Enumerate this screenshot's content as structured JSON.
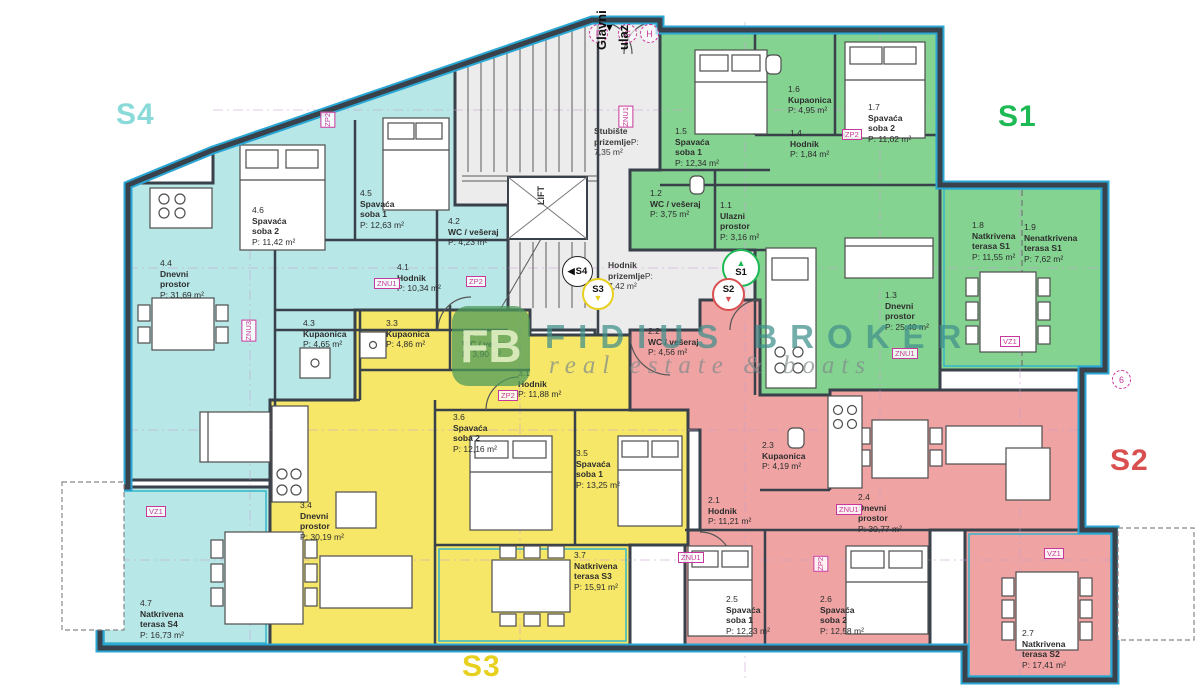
{
  "colors": {
    "s1": "#84d391",
    "s2": "#efa3a3",
    "s3": "#f6e768",
    "s4": "#b7e7e7",
    "common": "#ececec",
    "wall": "#39414a",
    "blue": "#2aa6d4",
    "tag": "#c8379b",
    "grid": "#c9a0cf",
    "s1-accent": "#1db954",
    "s2-accent": "#d94f4f",
    "s3-accent": "#e8d020",
    "s4-accent": "#8adada"
  },
  "units": {
    "s1": "S1",
    "s2": "S2",
    "s3": "S3",
    "s4": "S4"
  },
  "entrance": {
    "word1": "Glavni",
    "word2": "ulaz",
    "arrow": "▼"
  },
  "grid_bubbles": {
    "f": "F",
    "g": "G",
    "h": "H",
    "side": "6"
  },
  "badge_arrows": {
    "up": "▲",
    "down": "▼",
    "left": "◀"
  },
  "common_rooms": {
    "stairs_name": "Stubište prizemlje",
    "stairs_area": "P: 7,35 m²",
    "hall_name": "Hodnik prizemlje",
    "hall_area": "P: 7,42 m²",
    "lift": "LIFT"
  },
  "watermark": {
    "logo": "FB",
    "line1": "FIDIUS BROKER",
    "line2": "real estate & boats"
  },
  "tags": {
    "zp2": "ZP2",
    "znu1": "ZNU1",
    "znu3": "ZNU3",
    "vz1": "VZ1"
  },
  "apartments": [
    {
      "id": "S4",
      "rooms": [
        {
          "number": "4.1",
          "name": "Hodnik",
          "area": "P: 10,34 m²"
        },
        {
          "number": "4.2",
          "name": "WC / vešeraj",
          "area": "P: 4,23 m²"
        },
        {
          "number": "4.3",
          "name": "Kupaonica",
          "area": "P: 4,65 m²"
        },
        {
          "number": "4.4",
          "name": "Dnevni prostor",
          "area": "P: 31,69 m²"
        },
        {
          "number": "4.5",
          "name": "Spavaća soba 1",
          "area": "P: 12,63 m²"
        },
        {
          "number": "4.6",
          "name": "Spavaća soba 2",
          "area": "P: 11,42 m²"
        },
        {
          "number": "4.7",
          "name": "Natkrivena terasa S4",
          "area": "P: 16,73 m²"
        }
      ]
    },
    {
      "id": "S1",
      "rooms": [
        {
          "number": "1.1",
          "name": "Ulazni prostor",
          "area": "P: 3,16 m²"
        },
        {
          "number": "1.2",
          "name": "WC / vešeraj",
          "area": "P: 3,75 m²"
        },
        {
          "number": "1.3",
          "name": "Dnevni prostor",
          "area": "P: 25,40 m²"
        },
        {
          "number": "1.4",
          "name": "Hodnik",
          "area": "P: 1,84 m²"
        },
        {
          "number": "1.5",
          "name": "Spavaća soba 1",
          "area": "P: 12,34 m²"
        },
        {
          "number": "1.6",
          "name": "Kupaonica",
          "area": "P: 4,95 m²"
        },
        {
          "number": "1.7",
          "name": "Spavaća soba 2",
          "area": "P: 11,02 m²"
        },
        {
          "number": "1.8",
          "name": "Natkrivena terasa S1",
          "area": "P: 11,55 m²"
        },
        {
          "number": "1.9",
          "name": "Nenatkrivena terasa S1",
          "area": "P: 7,62 m²"
        }
      ]
    },
    {
      "id": "S2",
      "rooms": [
        {
          "number": "2.1",
          "name": "Hodnik",
          "area": "P: 11,21 m²"
        },
        {
          "number": "2.2",
          "name": "WC / vešeraj",
          "area": "P: 4,56 m²"
        },
        {
          "number": "2.3",
          "name": "Kupaonica",
          "area": "P: 4,19 m²"
        },
        {
          "number": "2.4",
          "name": "Dnevni prostor",
          "area": "P: 30,77 m²"
        },
        {
          "number": "2.5",
          "name": "Spavaća soba 1",
          "area": "P: 12,23 m²"
        },
        {
          "number": "2.6",
          "name": "Spavaća soba 2",
          "area": "P: 12,58 m²"
        },
        {
          "number": "2.7",
          "name": "Natkrivena terasa S2",
          "area": "P: 17,41 m²"
        }
      ]
    },
    {
      "id": "S3",
      "rooms": [
        {
          "number": "3.1",
          "name": "Hodnik",
          "area": "P: 11,88 m²"
        },
        {
          "number": "3.2",
          "name": "WC / vešeraj",
          "area": "P: 3,90 m²"
        },
        {
          "number": "3.3",
          "name": "Kupaonica",
          "area": "P: 4,86 m²"
        },
        {
          "number": "3.4",
          "name": "Dnevni prostor",
          "area": "P: 30,19 m²"
        },
        {
          "number": "3.5",
          "name": "Spavaća soba 1",
          "area": "P: 13,25 m²"
        },
        {
          "number": "3.6",
          "name": "Spavaća soba 2",
          "area": "P: 12,16 m²"
        },
        {
          "number": "3.7",
          "name": "Natkrivena terasa S3",
          "area": "P: 15,91 m²"
        }
      ]
    }
  ]
}
